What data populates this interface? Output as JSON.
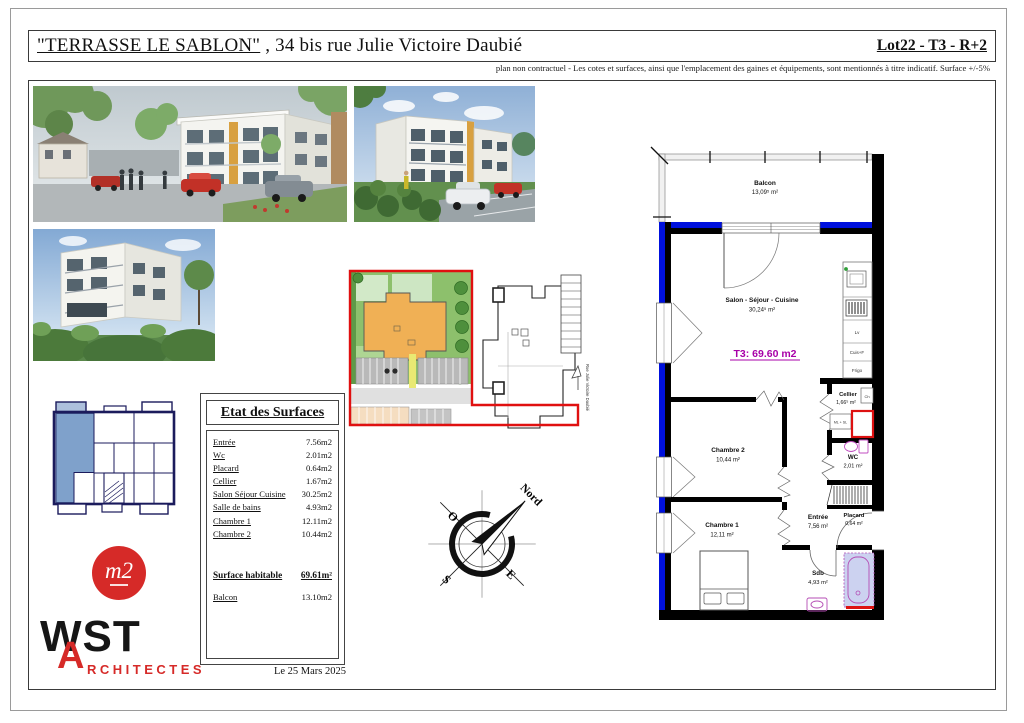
{
  "colors": {
    "wall_blue": "#0011dd",
    "plan_magenta": "#a800a8",
    "fixture_magenta": "#c04cc0",
    "alert_red": "#dd1111",
    "logo_red": "#d62a28",
    "site_green": "#8dc06c",
    "site_orange": "#f0b055",
    "key_unit_blue": "#7fa1cb"
  },
  "header": {
    "title_quoted": "\"TERRASSE LE SABLON\"",
    "title_rest": ", 34 bis rue Julie Victoire Daubié",
    "lot_label": "Lot22 - T3 - R+2",
    "disclaimer": "plan non contractuel - Les cotes et surfaces, ainsi que l'emplacement des gaines et équipements, sont mentionnés à titre indicatif. Surface +/-5%"
  },
  "surfaces_table": {
    "title": "Etat des Surfaces",
    "rows": [
      {
        "label": "Entrée",
        "value": "7.56m2"
      },
      {
        "label": "Wc",
        "value": "2.01m2"
      },
      {
        "label": "Placard",
        "value": "0.64m2"
      },
      {
        "label": "Cellier",
        "value": "1.67m2"
      },
      {
        "label": "Salon Séjour Cuisine",
        "value": "30.25m2"
      },
      {
        "label": "Salle de bains",
        "value": "4.93m2"
      },
      {
        "label": "Chambre 1",
        "value": "12.11m2"
      },
      {
        "label": "Chambre 2",
        "value": "10.44m2"
      }
    ],
    "total_label": "Surface habitable",
    "total_value": "69.61m²",
    "balcony_label": "Balcon",
    "balcony_value": "13.10m2"
  },
  "date_label": "Le 25 Mars 2025",
  "floor_plan": {
    "unit_label": "T3: 69.60 m2",
    "balcon_name": "Balcon",
    "balcon_area": "13,09⁵ m²",
    "salon_name": "Salon - Séjour - Cuisine",
    "salon_area": "30,24⁵ m²",
    "cellier_name": "Cellier",
    "cellier_area": "1,66⁵ m²",
    "wc_name": "WC",
    "wc_area": "2,01 m²",
    "placard_name": "Placard",
    "placard_area": "0,64 m²",
    "chambre2_name": "Chambre 2",
    "chambre2_area": "10,44 m²",
    "chambre1_name": "Chambre 1",
    "chambre1_area": "12,11 m²",
    "entree_name": "Entrée",
    "entree_area": "7,56 m²",
    "sdb_name": "Sdb",
    "sdb_area": "4,93 m²",
    "kitchen": {
      "lv": "Lv",
      "cuisf": "Cuis+F",
      "frigo": "Frigo",
      "ch": "Ch",
      "mlsl": "ML + SL"
    }
  },
  "compass": {
    "north": "Nord",
    "west": "O",
    "south": "S",
    "east": "E"
  },
  "site_plan": {
    "street_label": "Rue Julie Victoire Daubié"
  },
  "logos": {
    "m2_text": "m2",
    "wst_text": "WST",
    "architectes_a": "A",
    "architectes_rest": "RCHITECTES"
  }
}
